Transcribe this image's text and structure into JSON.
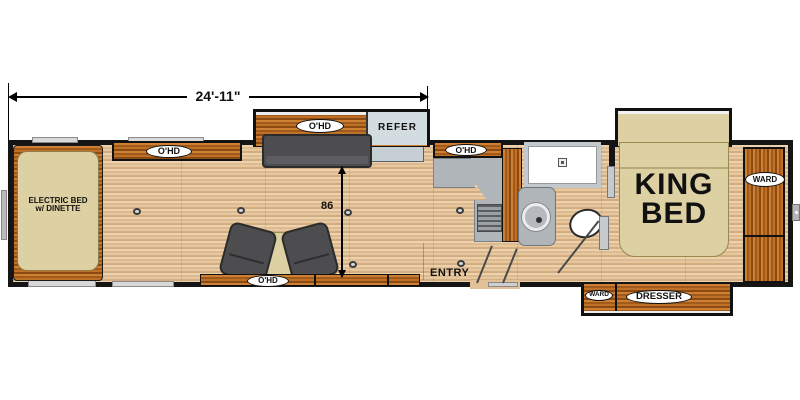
{
  "colors": {
    "wall": "#151515",
    "floor_light": "#ecd3ad",
    "floor_mid": "#d3ac80",
    "cabinet_wood_light": "#cd7f33",
    "cabinet_wood_dark": "#8a4a12",
    "furniture_gray": "#4d4d4f",
    "counter_gray": "#b0b5ba",
    "refer_gray": "#d3dce0",
    "bed_tan": "#ddd0a2",
    "window_gray": "#d8d8d8"
  },
  "dimensions": {
    "overall_length": "24'-11\"",
    "interior_width": "86"
  },
  "garage": {
    "bed_line1": "ELECTRIC BED",
    "bed_line2": "w/ DINETTE",
    "overhead": "O'HD"
  },
  "living": {
    "slide_overhead": "O'HD",
    "refrigerator": "REFER",
    "tv_overhead": "O'HD"
  },
  "kitchen": {
    "overhead": "O'HD",
    "entry": "ENTRY"
  },
  "bedroom": {
    "bed_line1": "KING",
    "bed_line2": "BED",
    "wardrobe": "WARD",
    "closet": "WARD",
    "dresser": "DRESSER"
  }
}
